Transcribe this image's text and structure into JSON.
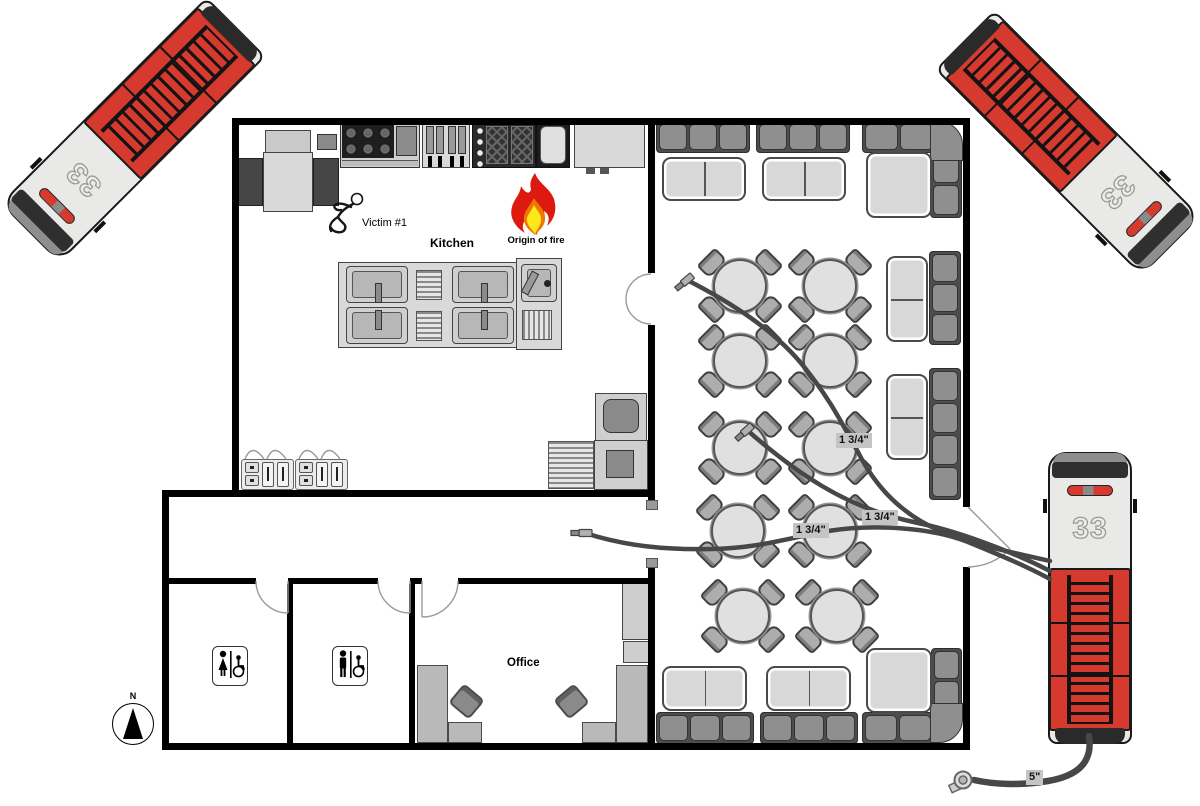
{
  "labels": {
    "victim": "Victim #1",
    "kitchen": "Kitchen",
    "origin_of_fire": "Origin of fire",
    "office": "Office",
    "north": "N"
  },
  "hoses": {
    "attack": [
      "1 3/4\"",
      "1 3/4\"",
      "1 3/4\""
    ],
    "supply": "5\""
  },
  "trucks": [
    {
      "unit": "33",
      "position": "top-left"
    },
    {
      "unit": "33",
      "position": "top-right"
    },
    {
      "unit": "33",
      "position": "right"
    }
  ],
  "colors": {
    "truck_red": "#d6392e",
    "wall": "#000000",
    "hose": "#474747",
    "flame_red": "#dd1a10",
    "flame_yellow": "#ffe81a",
    "label_bg": "#c4c4c4"
  }
}
